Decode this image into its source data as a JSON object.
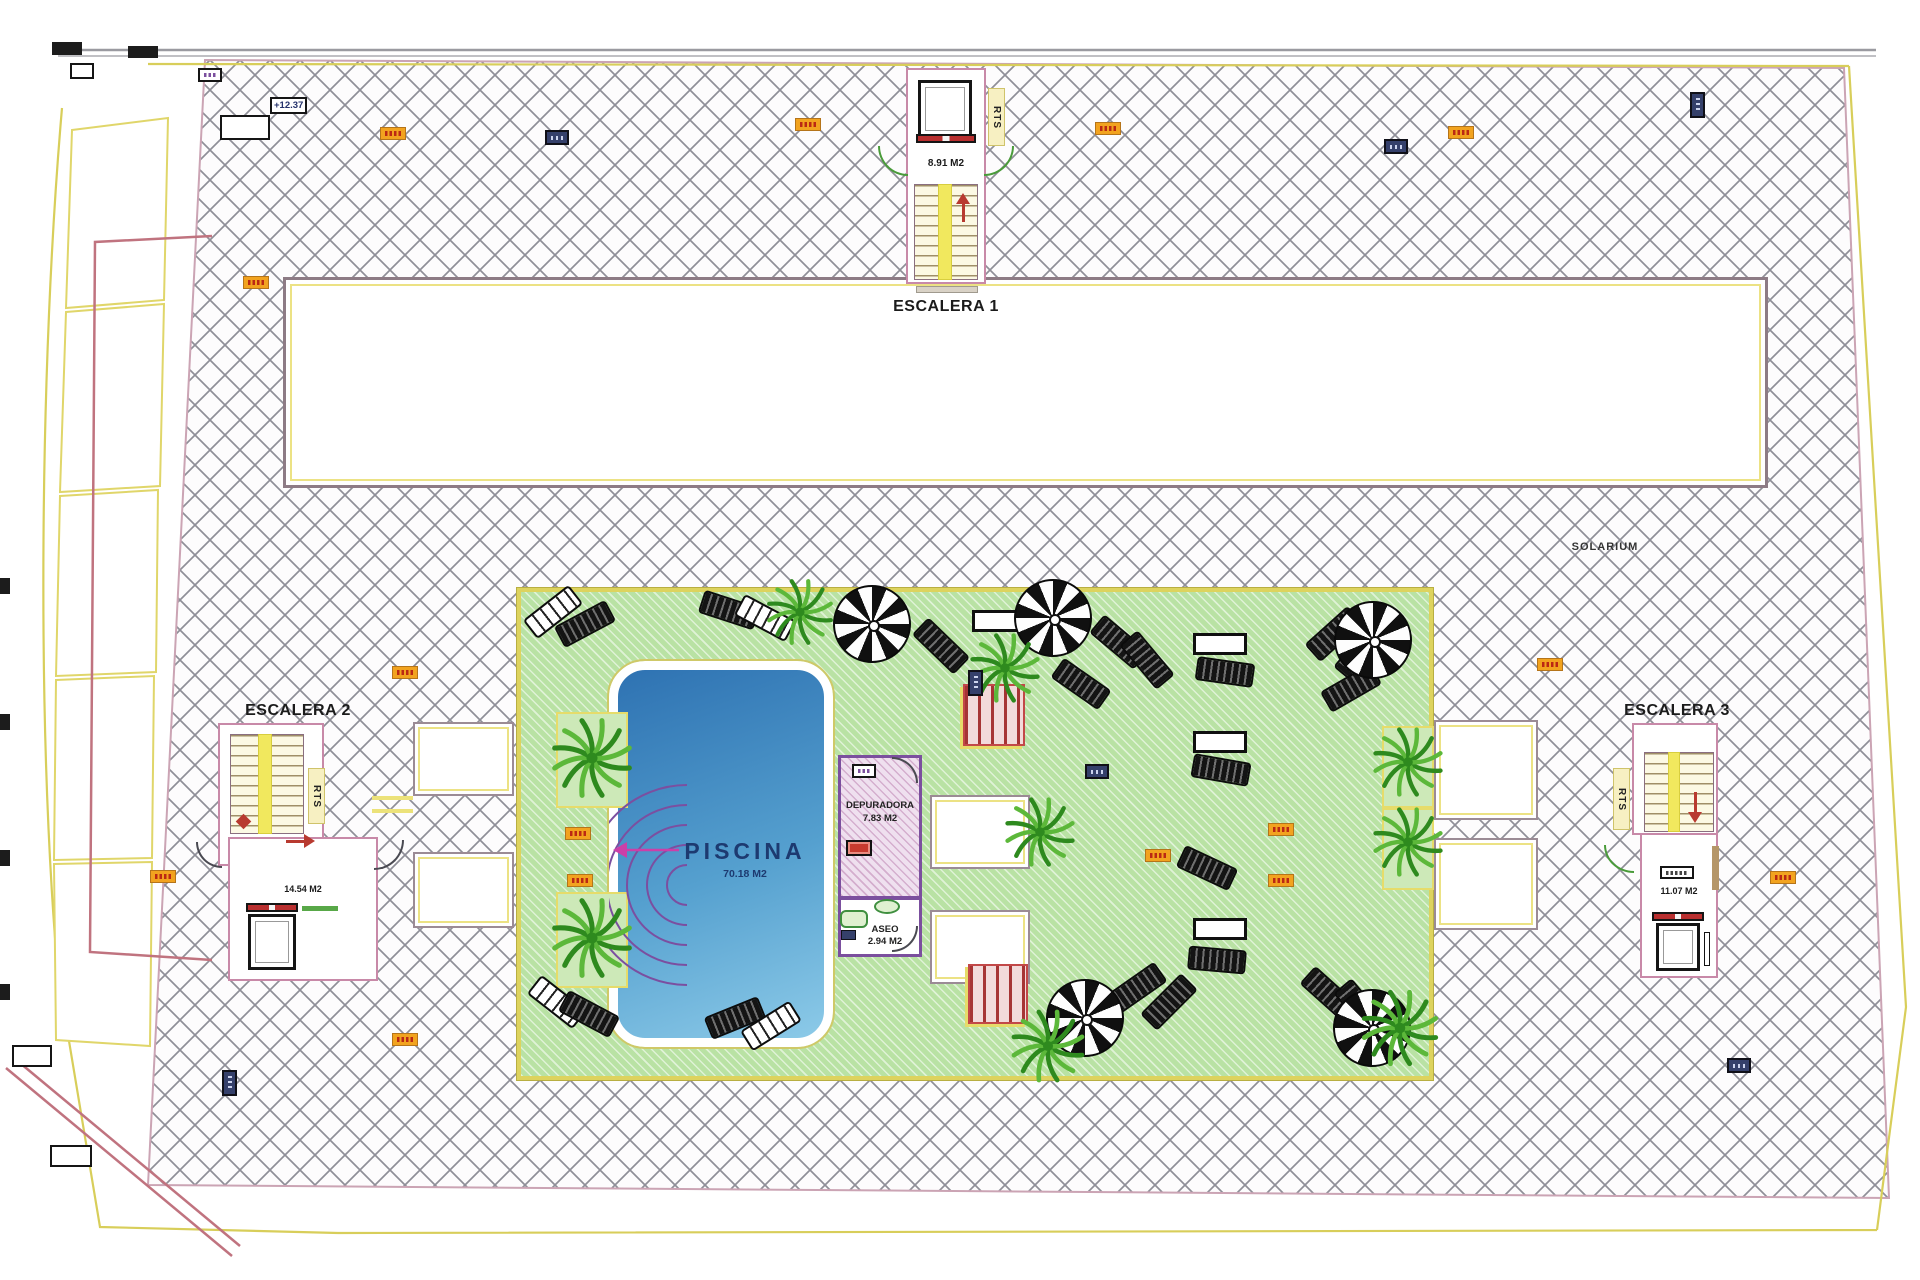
{
  "labels": {
    "solarium": "SOLARIUM",
    "elevation": "+12.37",
    "escalera1": {
      "name": "ESCALERA 1",
      "area": "8.91 M2",
      "rts": "RTS"
    },
    "escalera2": {
      "name": "ESCALERA 2",
      "area": "14.54 M2",
      "rts": "RTS"
    },
    "escalera3": {
      "name": "ESCALERA 3",
      "area": "11.07 M2",
      "rts": "RTS"
    },
    "piscina": {
      "name": "PISCINA",
      "area": "70.18 M2"
    },
    "depuradora": {
      "name": "DEPURADORA",
      "area": "7.83 M2"
    },
    "aseo": {
      "name": "ASEO",
      "area": "2.94 M2"
    }
  },
  "colors": {
    "hatch_line": "#8f8f98",
    "deck_green": "#b9e2a4",
    "deck_border": "#ddd35e",
    "pool_dark": "#2e72b2",
    "pool_light": "#8ccae8",
    "boundary_yellow": "#d8ce5a",
    "boundary_pink": "#c0737f",
    "room_purple": "#7b4f9e",
    "stair_pink": "#c889a8",
    "marker_orange": "#f2a31f",
    "marker_navy": "#35406b",
    "arrow_red": "#b83a30",
    "steps_purple": "#7b4fa0",
    "palm_green": "#2e8a1e"
  },
  "plan_items": {
    "palms": [
      [
        592,
        758,
        46
      ],
      [
        592,
        938,
        46
      ],
      [
        800,
        612,
        38
      ],
      [
        1005,
        668,
        40
      ],
      [
        1040,
        832,
        40
      ],
      [
        1048,
        1046,
        42
      ],
      [
        1408,
        762,
        40
      ],
      [
        1408,
        842,
        40
      ],
      [
        1400,
        1028,
        44
      ]
    ],
    "planters": [
      [
        556,
        712,
        72,
        96
      ],
      [
        556,
        892,
        72,
        96
      ],
      [
        1382,
        726,
        52,
        82
      ],
      [
        1382,
        808,
        52,
        82
      ]
    ],
    "parasols": [
      [
        1053,
        618
      ],
      [
        1373,
        640
      ],
      [
        872,
        624
      ],
      [
        1085,
        1018
      ],
      [
        1372,
        1028
      ]
    ],
    "loungers": [
      [
        524,
        600,
        -38,
        "bw"
      ],
      [
        556,
        612,
        -28,
        "dark"
      ],
      [
        700,
        598,
        18,
        "dark"
      ],
      [
        736,
        606,
        28,
        "bw"
      ],
      [
        912,
        634,
        44,
        "dark"
      ],
      [
        1090,
        630,
        40,
        "dark"
      ],
      [
        1118,
        648,
        50,
        "dark"
      ],
      [
        1052,
        672,
        35,
        "dark"
      ],
      [
        1305,
        622,
        -42,
        "dark"
      ],
      [
        1332,
        640,
        -50,
        "dark"
      ],
      [
        1322,
        676,
        -30,
        "dark"
      ],
      [
        1196,
        660,
        8,
        "dark"
      ],
      [
        1192,
        758,
        10,
        "dark"
      ],
      [
        1178,
        856,
        25,
        "dark"
      ],
      [
        1188,
        948,
        5,
        "dark"
      ],
      [
        528,
        990,
        38,
        "bw"
      ],
      [
        560,
        1002,
        28,
        "dark"
      ],
      [
        706,
        1006,
        -22,
        "dark"
      ],
      [
        742,
        1014,
        -32,
        "bw"
      ],
      [
        1108,
        976,
        -35,
        "dark"
      ],
      [
        1140,
        990,
        -45,
        "dark"
      ],
      [
        1300,
        982,
        42,
        "dark"
      ],
      [
        1332,
        996,
        50,
        "dark"
      ]
    ],
    "tables": [
      [
        1193,
        633
      ],
      [
        1193,
        731
      ],
      [
        1193,
        918
      ],
      [
        972,
        610
      ]
    ],
    "markers": {
      "orange": [
        [
          380,
          127
        ],
        [
          795,
          118
        ],
        [
          1095,
          122
        ],
        [
          1448,
          126
        ],
        [
          243,
          276
        ],
        [
          565,
          827
        ],
        [
          567,
          874
        ],
        [
          392,
          666
        ],
        [
          392,
          1033
        ],
        [
          150,
          870
        ],
        [
          1770,
          871
        ],
        [
          1537,
          658
        ],
        [
          1145,
          849
        ],
        [
          1268,
          823
        ],
        [
          1268,
          874
        ]
      ],
      "navy": [
        [
          545,
          130
        ],
        [
          1384,
          139
        ],
        [
          1085,
          764
        ],
        [
          1727,
          1058
        ]
      ],
      "navyv": [
        [
          1690,
          92
        ],
        [
          968,
          670
        ],
        [
          222,
          1070
        ]
      ],
      "navys": [
        [
          841,
          930
        ]
      ],
      "purple": [
        [
          852,
          764
        ],
        [
          198,
          68
        ]
      ],
      "blklabel": [
        [
          1660,
          866
        ]
      ],
      "wbox": [
        [
          220,
          115,
          50,
          25
        ],
        [
          70,
          63,
          24,
          16
        ],
        [
          12,
          1045,
          40,
          22
        ],
        [
          50,
          1145,
          42,
          22
        ]
      ],
      "black": [
        [
          52,
          42,
          30,
          13
        ],
        [
          128,
          46,
          30,
          12
        ],
        [
          0,
          578,
          10,
          16
        ],
        [
          0,
          714,
          10,
          16
        ],
        [
          0,
          850,
          10,
          16
        ],
        [
          0,
          984,
          10,
          16
        ]
      ]
    }
  }
}
